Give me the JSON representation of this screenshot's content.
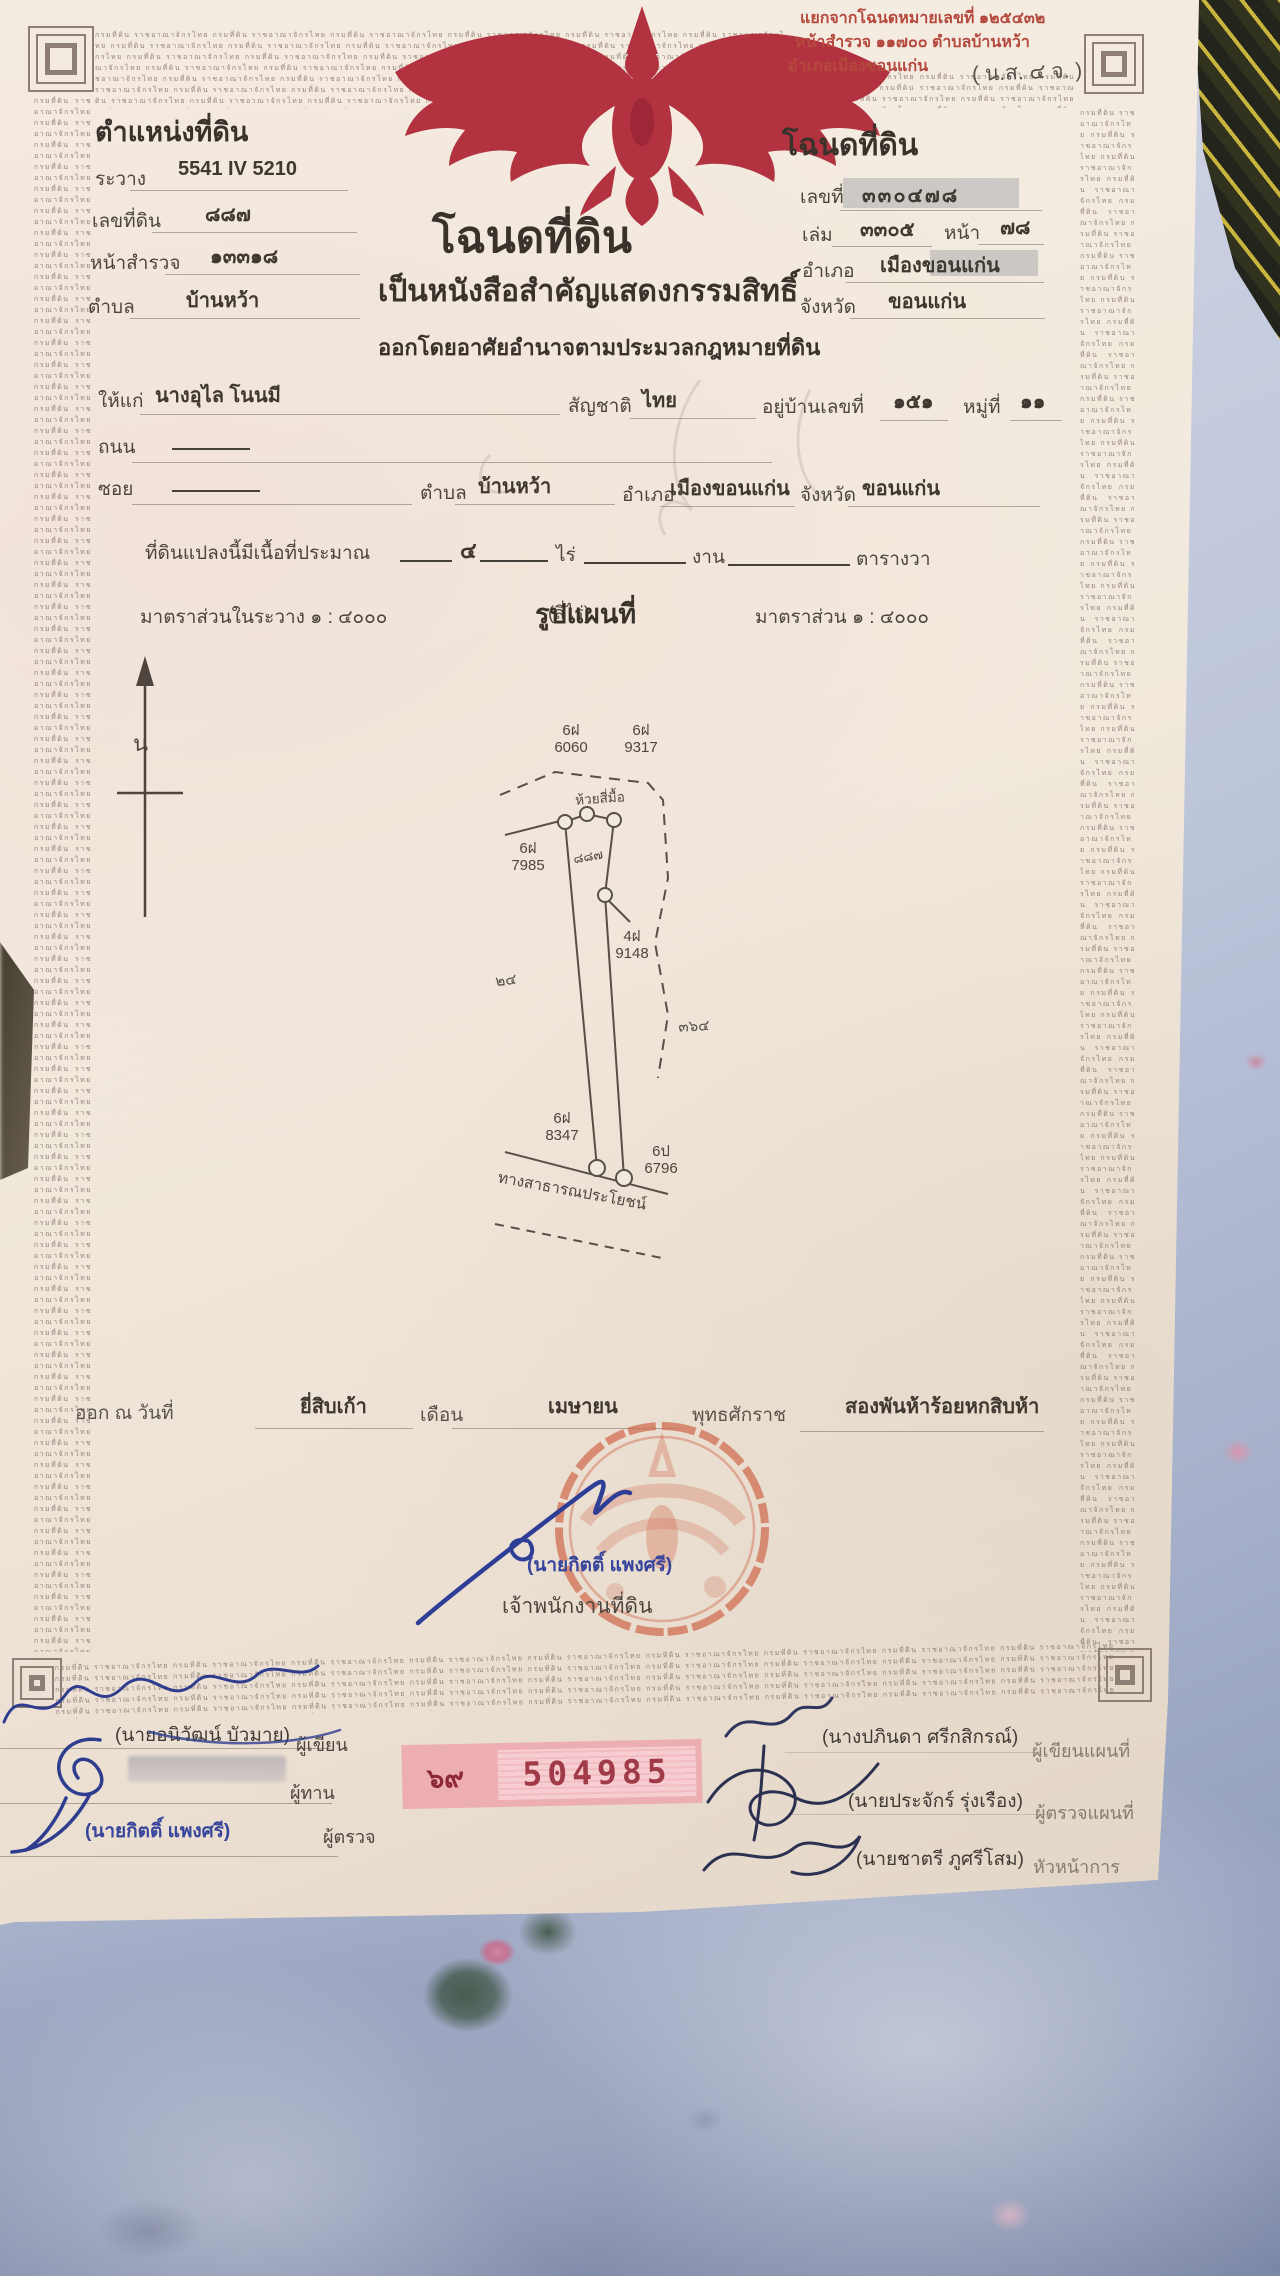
{
  "border": {
    "microtext": "กรมที่ดิน ราชอาณาจักรไทย"
  },
  "header_note": {
    "line1": "แยกจากโฉนดหมายเลขที่ ๑๒๕๔๓๒",
    "line2": "หน้าสำรวจ ๑๑๗๐๐ ตำบลบ้านหว้า",
    "line3": "อำเภอเมืองขอนแก่น",
    "form_code": "( น.ส. ๔ จ. )"
  },
  "position_block": {
    "title": "ตำแหน่งที่ดิน",
    "rawang_label": "ระวาง",
    "rawang": "5541 IV 5210",
    "parcel_no_label": "เลขที่ดิน",
    "parcel_no": "๘๘๗",
    "survey_page_label": "หน้าสำรวจ",
    "survey_page": "๑๓๓๑๘",
    "tambon_label": "ตำบล",
    "tambon": "บ้านหว้า"
  },
  "deed_block": {
    "title": "โฉนดที่ดิน",
    "no_label": "เลขที่",
    "no": "๓๓๐๔๗๘",
    "volume_label": "เล่ม",
    "volume": "๓๓๐๕",
    "page_label": "หน้า",
    "page": "๗๘",
    "amphoe_label": "อำเภอ",
    "amphoe": "เมืองขอนแก่น",
    "province_label": "จังหวัด",
    "province": "ขอนแก่น"
  },
  "title_block": {
    "main": "โฉนดที่ดิน",
    "sub": "เป็นหนังสือสำคัญแสดงกรรมสิทธิ์",
    "authority": "ออกโดยอาศัยอำนาจตามประมวลกฎหมายที่ดิน"
  },
  "owner": {
    "given_label": "ให้แก่",
    "name": "นางอุไล โนนมี",
    "nationality_label": "สัญชาติ",
    "nationality": "ไทย",
    "house_label": "อยู่บ้านเลขที่",
    "house_no": "๑๕๑",
    "moo_label": "หมู่ที่",
    "moo": "๑๑",
    "road_label": "ถนน",
    "road_value": "————",
    "soi_label": "ซอย",
    "soi_value": "————",
    "tambon_label": "ตำบล",
    "tambon": "บ้านหว้า",
    "amphoe_label": "อำเภอ",
    "amphoe": "เมืองขอนแก่น",
    "province_label": "จังหวัด",
    "province": "ขอนแก่น"
  },
  "area": {
    "prefix": "ที่ดินแปลงนี้มีเนื้อที่ประมาณ",
    "rai": "๔",
    "rai_label": "ไร่",
    "ngan_label": "งาน",
    "wa_label": "ตารางวา",
    "in_words": "(สี่ไร่)"
  },
  "scale": {
    "left": "มาตราส่วนในระวาง ๑ : ๔๐๐๐",
    "map_title": "รูปแผนที่",
    "right": "มาตราส่วน ๑ : ๔๐๐๐"
  },
  "map": {
    "north": "น",
    "stream": "ห้วยสี่มื้อ",
    "parcel_no": "๘๘๗",
    "note_left": "๒๔",
    "note_right": "๓๖๔",
    "road": "ทางสาธารณประโยชน์",
    "markers": [
      {
        "prefix": "6ฝ",
        "number": "6060"
      },
      {
        "prefix": "6ฝ",
        "number": "9317"
      },
      {
        "prefix": "6ฝ",
        "number": "7985"
      },
      {
        "prefix": "4ฝ",
        "number": "9148"
      },
      {
        "prefix": "6ฝ",
        "number": "8347"
      },
      {
        "prefix": "6ป",
        "number": "6796"
      }
    ]
  },
  "issue": {
    "prefix": "ออก ณ วันที่",
    "day": "ยี่สิบเก้า",
    "month_label": "เดือน",
    "month": "เมษายน",
    "era_label": "พุทธศักราช",
    "year": "สองพันห้าร้อยหกสิบห้า"
  },
  "officer": {
    "name": "(นายกิตติ์ แพงศรี)",
    "title": "เจ้าพนักงานที่ดิน"
  },
  "serial": {
    "book": "๖๙",
    "number": "504985"
  },
  "signers_left": [
    {
      "name": "(นายอนิวัฒน์ บัวมาย)",
      "role": "ผู้เขียน"
    },
    {
      "name": "",
      "role": "ผู้ทาน"
    },
    {
      "name": "(นายกิตติ์ แพงศรี)",
      "role": "ผู้ตรวจ"
    }
  ],
  "signers_right": [
    {
      "name": "(นางปภินดา ศรีกสิกรณ์)",
      "role": "ผู้เขียนแผนที่"
    },
    {
      "name": "(นายประจักร์ รุ่งเรือง)",
      "role": "ผู้ตรวจแผนที่"
    },
    {
      "name": "(นายชาตรี ภูศรีโสม)",
      "role": "หัวหน้าการ"
    }
  ]
}
